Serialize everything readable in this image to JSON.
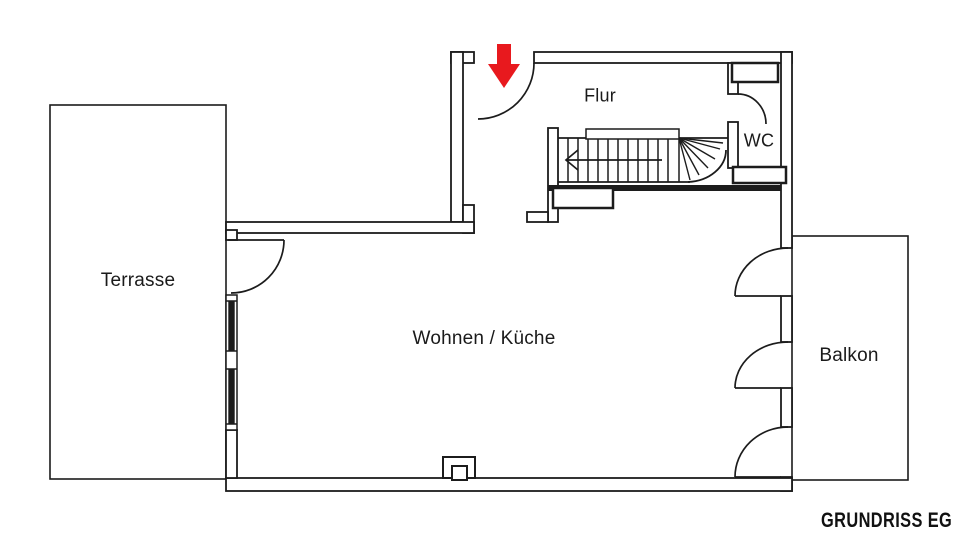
{
  "plan": {
    "title": "GRUNDRISS EG",
    "rooms": [
      {
        "id": "terrasse",
        "label": "Terrasse"
      },
      {
        "id": "wohnen-kueche",
        "label": "Wohnen / Küche"
      },
      {
        "id": "flur",
        "label": "Flur"
      },
      {
        "id": "wc",
        "label": "WC"
      },
      {
        "id": "balkon",
        "label": "Balkon"
      }
    ],
    "icons": [
      {
        "name": "entrance-arrow-icon",
        "meaning": "main entrance direction marker"
      },
      {
        "name": "stair-direction-arrow",
        "meaning": "staircase walk direction"
      }
    ],
    "colors": {
      "line": "#1c1c1c",
      "entrance_arrow": "#e8191e",
      "background": "#ffffff"
    }
  }
}
